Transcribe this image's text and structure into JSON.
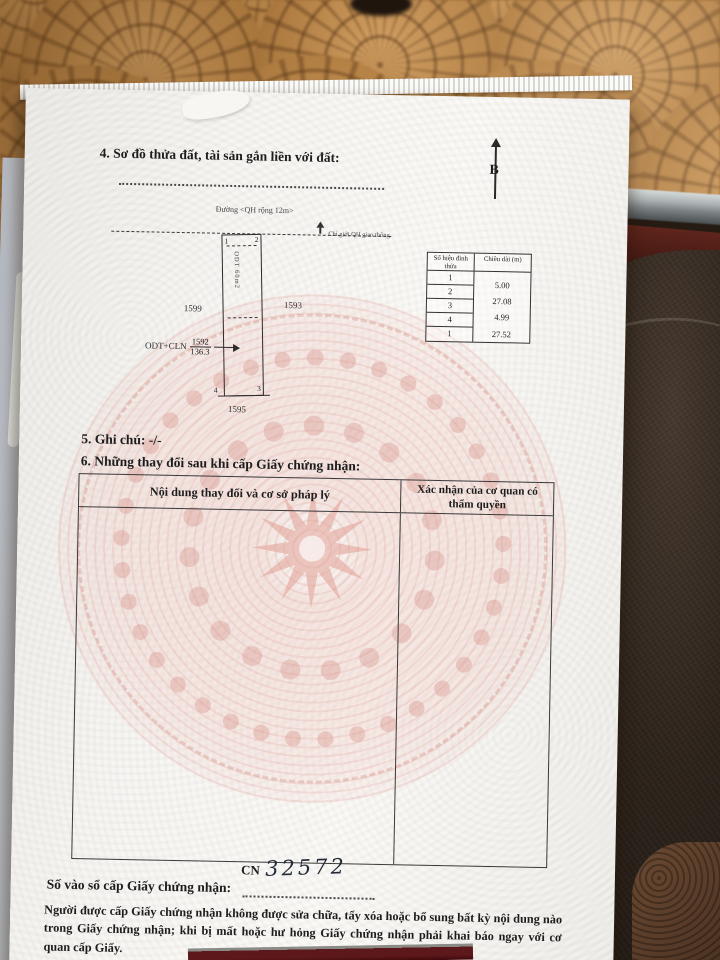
{
  "document": {
    "section4": {
      "heading": "4. Sơ đồ thửa đất, tài sản gắn liền với đất:",
      "north_label": "B",
      "road_label": "Đường <QH rộng 12m>",
      "boundary_label": "Chỉ giới QH giao thông",
      "parcel": {
        "corners": [
          "1",
          "2",
          "3",
          "4"
        ],
        "inner_label": "ODT 60m2",
        "left_neighbor": "1599",
        "right_neighbor": "1593",
        "bottom_neighbor": "1595",
        "use_label": "ODT+CLN",
        "parcel_number": "1592",
        "area": "136.3"
      },
      "vertex_table": {
        "col1_header": "Số hiệu đỉnh thửa",
        "col2_header": "Chiều dài (m)",
        "vertices": [
          "1",
          "2",
          "3",
          "4",
          "1"
        ],
        "lengths": [
          "5.00",
          "27.08",
          "4.99",
          "27.52"
        ]
      }
    },
    "section5": {
      "text": "5. Ghi chú: -/-"
    },
    "section6": {
      "heading": "6. Những thay đổi sau khi cấp Giấy chứng nhận:",
      "col1_header": "Nội dung thay đổi và cơ sở pháp lý",
      "col2_header": "Xác nhận của cơ quan có thẩm quyền"
    },
    "registry": {
      "label": "Số vào sổ cấp Giấy chứng nhận:",
      "prefix": "CN",
      "number": "32572"
    },
    "notice": "Người được cấp Giấy chứng nhận không được sửa chữa, tẩy xóa hoặc bổ sung bất kỳ nội dung nào trong Giấy chứng nhận; khi bị mất hoặc hư hỏng Giấy chứng nhận phải khai báo ngay với cơ quan cấp Giấy."
  }
}
